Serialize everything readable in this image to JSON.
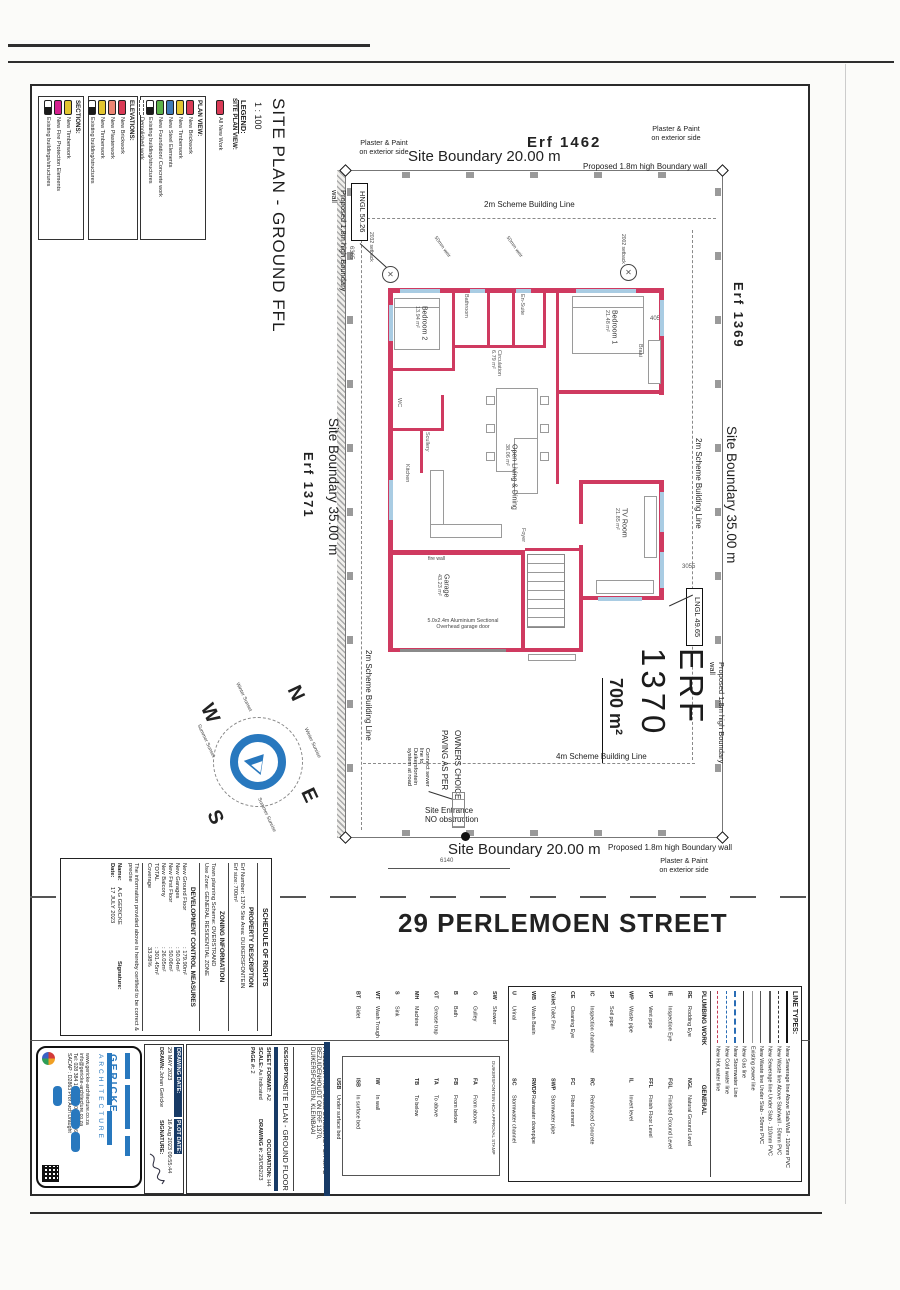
{
  "page": {
    "street": "29 PERLEMOEN STREET"
  },
  "title": {
    "main": "SITE PLAN - GROUND FFL",
    "scale": "1 : 100",
    "legend_heading": "LEGEND:"
  },
  "legend": {
    "site_plan_view": {
      "heading": "SITE PLAN VIEW:",
      "items": [
        {
          "label": "All New Work",
          "swatch": "red"
        }
      ]
    },
    "plan_view": {
      "heading": "PLAN VIEW:",
      "items": [
        {
          "label": "New Brickwork",
          "swatch": "red"
        },
        {
          "label": "New Timberwork",
          "swatch": "yellow"
        },
        {
          "label": "New Steel Elements",
          "swatch": "blue"
        },
        {
          "label": "New Foundation/ Concrete work",
          "swatch": "green"
        },
        {
          "label": "Existing building/structures",
          "swatch": "existing"
        },
        {
          "label": "Demolished work",
          "swatch": "dashed"
        }
      ]
    },
    "elevations": {
      "heading": "ELEVATIONS:",
      "items": [
        {
          "label": "New Brickwork",
          "swatch": "red"
        },
        {
          "label": "New Plasterwork",
          "swatch": "salmon"
        },
        {
          "label": "New Timberwork",
          "swatch": "yellow"
        },
        {
          "label": "Existing building/structures",
          "swatch": "existing"
        }
      ]
    },
    "sections": {
      "heading": "SECTIONS:",
      "items": [
        {
          "label": "New Timberwork",
          "swatch": "yellow"
        },
        {
          "label": "New Fire Protection Elements",
          "swatch": "magenta"
        },
        {
          "label": "Existing buildings/structures",
          "swatch": "existing"
        }
      ]
    }
  },
  "site": {
    "erf_top": "Erf 1462",
    "erf_left": "Erf 1371",
    "erf_right": "Erf 1369",
    "erf_main": "ERF 1370",
    "erf_area": "700 m²",
    "boundary_top": "Site Boundary 20.00 m",
    "boundary_bottom": "Site Boundary 20.00 m",
    "boundary_left": "Site Boundary 35.00 m",
    "boundary_right": "Site Boundary 35.00 m",
    "wall_note": "Proposed 1.8m high Boundary wall",
    "plaster_line1": "Plaster & Paint",
    "plaster_line2": "on exterior side",
    "scheme_2m": "2m Scheme Building Line",
    "scheme_4m": "4m Scheme Building Line",
    "hngl": "HNGL 50.26",
    "lngl": "LNGL 49.65",
    "paving_line1": "PAVING AS PER",
    "paving_line2": "OWNERS CHOICE",
    "sewer_note": [
      "Connect sewer",
      "line to",
      "Duikersfontein",
      "system at road"
    ],
    "entrance_line1": "Site Entrance",
    "entrance_line2": "NO obstruction",
    "dims": {
      "d6140": "6140",
      "d6365": "6365",
      "d2032": "2032 setback",
      "d2002": "2002 setback",
      "d4055": "4055",
      "d3055": "3055",
      "weir": "50mm weir"
    }
  },
  "rooms": {
    "bedroom2": {
      "name": "Bedroom 2",
      "area": "13.94 m²"
    },
    "bedroom1": {
      "name": "Bedroom 1",
      "area": "21.48 m²"
    },
    "bathroom": {
      "name": "Bathroom"
    },
    "ensuite": {
      "name": "En-Suite"
    },
    "wc": {
      "name": "WC"
    },
    "circulation": {
      "name": "Circulation",
      "area": "6.79 m²"
    },
    "scullery": {
      "name": "Scullery"
    },
    "kitchen": {
      "name": "Kitchen"
    },
    "living": {
      "name": "Open Living & Dining",
      "area": "38.06 m²"
    },
    "tv": {
      "name": "TV Room",
      "area": "21.85 m²"
    },
    "garage": {
      "name": "Garage",
      "area": "43.23 m²"
    },
    "foyer": {
      "name": "Foyer"
    },
    "braai": {
      "name": "Braai"
    },
    "firewall": "fire wall",
    "garage_door_1": "5.0x2.4m Aluminium Sectional",
    "garage_door_2": "Overhead garage door"
  },
  "compass": {
    "n": "N",
    "s": "S",
    "e": "E",
    "w": "W",
    "winter_sunset": "Winter Sunset",
    "summer_sunset": "Summer Sunset",
    "winter_sunrise": "Winter Sunrise",
    "summer_sunrise": "Summer Sunrise"
  },
  "schedule": {
    "heading": "SCHEDULE OF RIGHTS",
    "property": {
      "heading": "PROPERTY DESCRIPTION",
      "line1": "Erf Number: 1370   Site Area: DUIKERSFONTEIN",
      "line2": "Erf size: 700m²"
    },
    "zoning": {
      "heading": "ZONING INFORMATION",
      "line1": "Town planning Scheme:   OVERSTRAND",
      "line2": "Use Zone: GENERAL RESIDENTIAL ZONE"
    },
    "dev": {
      "heading": "DEVELOPMENT CONTROL MEASURES",
      "rows": [
        {
          "label": "New Ground Floor",
          "value": ": 179.90m²"
        },
        {
          "label": "New Garages",
          "value": ": 50.04m²"
        },
        {
          "label": "New First Floor",
          "value": ": 50.06m²"
        },
        {
          "label": "New Balcony",
          "value": ": 26.05m²"
        },
        {
          "label": "TOTAL",
          "value": ": 301.45m²"
        },
        {
          "label": "Coverage",
          "value": "33.98%"
        }
      ]
    },
    "certify": "The information provided above is hereby certified to be correct & precise",
    "name_label": "Name:",
    "name_value": "A.G GERICKE",
    "signature_label": "Signature:",
    "date_label": "Date:",
    "date_value": "17 JULY 2023"
  },
  "titleblock": {
    "project_label": "PROJECT:",
    "project_value": "PROPOSED DWELLING FOR MR D BEZUIDENHOUDT ON ERF 1370, DUIKERSFONTEIN, KLEINBAAI",
    "description_label": "DESCRIPTION:",
    "description_value": "SITE PLAN - GROUND FLOOR",
    "sheet_format_label": "SHEET FORMAT:",
    "sheet_format": "A2",
    "occupation_label": "OCCUPATION:",
    "occupation": "H4",
    "scale_label": "SCALE:",
    "scale_value": "As Indicated",
    "drawing_no_label": "DRAWING #:",
    "drawing_no": "29/DB2/23",
    "page_label": "PAGE #:",
    "page_value": "2",
    "drawn_label": "DRAWN:",
    "drawn_value": "Johan Gericke",
    "drawing_date_label": "DRAWING DATE:",
    "drawing_date": "29 MAY 2023",
    "plot_date_label": "PLOT DATE:",
    "plot_date": "16 Aug 2023 09:55:44",
    "signature_label": "SIGNATURE:"
  },
  "firm": {
    "name": "GERICKE",
    "type": "ARCHITECTURE",
    "website": "www.gericke-architecture.co.za",
    "email": "info@gericke-architecture.co.za",
    "phone": "Tel: 028 384 1655   Sel: 082 463 6654",
    "sacap": "SACAP : D2863 Prof Arch Draught"
  },
  "stamp": {
    "label": "DUIKERSFONTEIN HOA APPROVAL STAMP"
  },
  "linetypes": {
    "heading": "LINE TYPES:",
    "items": [
      {
        "label": "New Sewerage line Above Slab/Wall - 110mm PVC",
        "style": "sewer-above"
      },
      {
        "label": "New Waste line Above Slab/wall - 50mm PVC",
        "style": "waste-above"
      },
      {
        "label": "New Sewerage line Under Slab - 110mm PVC",
        "style": "sewer-under"
      },
      {
        "label": "New Waste line Under Slab - 50mm PVC",
        "style": "waste-under"
      },
      {
        "label": "Existing sewer line",
        "style": "existing"
      },
      {
        "label": "New Gas line",
        "style": "gas"
      },
      {
        "label": "New Stormwater Line",
        "style": "storm"
      },
      {
        "label": "New Cold water line",
        "style": "cold"
      },
      {
        "label": "New Hot water line",
        "style": "hot"
      }
    ]
  },
  "abbr": {
    "plumbing_heading": "PLUMBING WORK",
    "general_heading": "GENERAL",
    "rows": [
      {
        "pa": "RE",
        "pd": "Rodding Eye",
        "ga": "NGL",
        "gd": "Natural Ground Level"
      },
      {
        "pa": "IE",
        "pd": "Inspection Eye",
        "ga": "FGL",
        "gd": "Finished Ground Level"
      },
      {
        "pa": "VP",
        "pd": "Vent pipe",
        "ga": "FFL",
        "gd": "Finish Floor Level"
      },
      {
        "pa": "WP",
        "pd": "Waste pipe",
        "ga": "IL",
        "gd": "Invert level"
      },
      {
        "pa": "SP",
        "pd": "Soil pipe",
        "ga": "",
        "gd": ""
      },
      {
        "pa": "IC",
        "pd": "Inspection chamber",
        "ga": "RC",
        "gd": "Reinforced Concrete"
      },
      {
        "pa": "CE",
        "pd": "Cleaning Eye",
        "ga": "FC",
        "gd": "Fibre cement"
      },
      {
        "pa": "Toilet",
        "pd": "Toilet Pan",
        "ga": "SWP",
        "gd": "Stormwater pipe"
      },
      {
        "pa": "WB",
        "pd": "Wash Basin",
        "ga": "RWDP",
        "gd": "Rainwater downpipe"
      },
      {
        "pa": "U",
        "pd": "Urinal",
        "ga": "SC",
        "gd": "Stormwater channel"
      },
      {
        "pa": "SW",
        "pd": "Shower",
        "ga": "",
        "gd": ""
      },
      {
        "pa": "G",
        "pd": "Gulley",
        "ga": "FA",
        "gd": "From above"
      },
      {
        "pa": "B",
        "pd": "Bath",
        "ga": "FB",
        "gd": "From below"
      },
      {
        "pa": "GT",
        "pd": "Grease trap",
        "ga": "TA",
        "gd": "To above"
      },
      {
        "pa": "MH",
        "pd": "Machine",
        "ga": "TB",
        "gd": "To below"
      },
      {
        "pa": "S",
        "pd": "Sink",
        "ga": "",
        "gd": ""
      },
      {
        "pa": "WT",
        "pd": "Wash Trough",
        "ga": "IW",
        "gd": "In wall"
      },
      {
        "pa": "BT",
        "pd": "Bidet",
        "ga": "ISB",
        "gd": "In surface bed"
      },
      {
        "pa": "",
        "pd": "",
        "ga": "USB",
        "gd": "Under surface bed"
      }
    ]
  },
  "colors": {
    "wall_red": "#cf3a60",
    "window_blue": "#a9cce3",
    "logo_blue": "#2878be",
    "navy_header": "#173a66",
    "swatch_red": "#d93a56",
    "swatch_yellow": "#e3c52f",
    "swatch_blue": "#3d7ab8",
    "swatch_green": "#5cb148",
    "swatch_salmon": "#ec8573",
    "swatch_magenta": "#d6218f"
  }
}
